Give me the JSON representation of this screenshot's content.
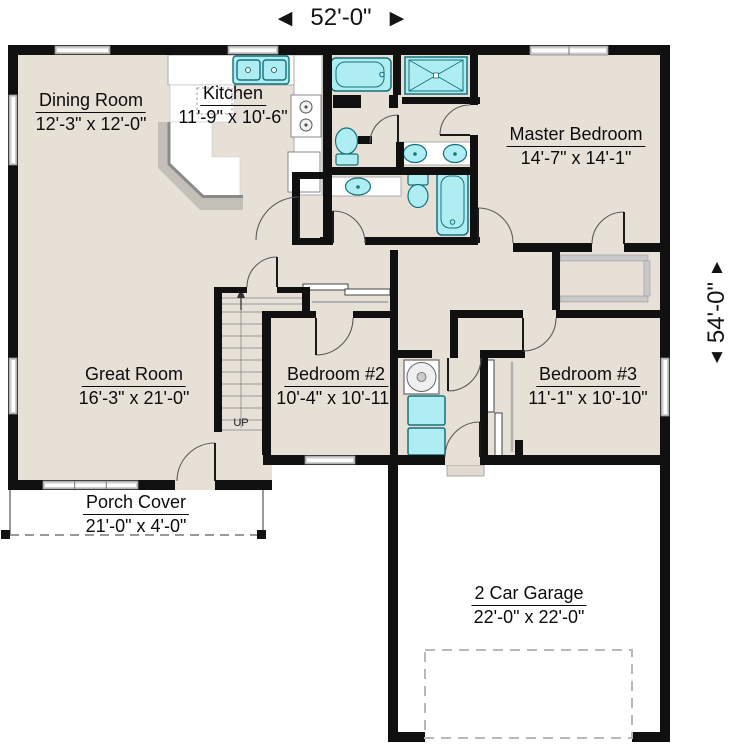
{
  "plan": {
    "width_dim": "52'-0\"",
    "height_dim": "54'-0\"",
    "stairs_label": "UP",
    "arrows": {
      "left": "◀",
      "right": "▶",
      "up": "▲",
      "down": "▼"
    },
    "rooms": {
      "dining": {
        "name": "Dining Room",
        "dims": "12'-3\" x 12'-0\""
      },
      "kitchen": {
        "name": "Kitchen",
        "dims": "11'-9\" x 10'-6\""
      },
      "master": {
        "name": "Master Bedroom",
        "dims": "14'-7\" x 14'-1\""
      },
      "great": {
        "name": "Great Room",
        "dims": "16'-3\" x 21'-0\""
      },
      "bed2": {
        "name": "Bedroom #2",
        "dims": "10'-4\" x 10'-11\""
      },
      "bed3": {
        "name": "Bedroom #3",
        "dims": "11'-1\" x 10'-10\""
      },
      "porch": {
        "name": "Porch Cover",
        "dims": "21'-0\" x 4'-0\""
      },
      "garage": {
        "name": "2 Car Garage",
        "dims": "22'-0\" x 22'-0\""
      }
    },
    "colors": {
      "wall": "#101010",
      "floor": "#e7e0d7",
      "fixture": "#aeeef2",
      "fixture_border": "#16707c",
      "counter_edge": "#8a8a8a"
    }
  }
}
